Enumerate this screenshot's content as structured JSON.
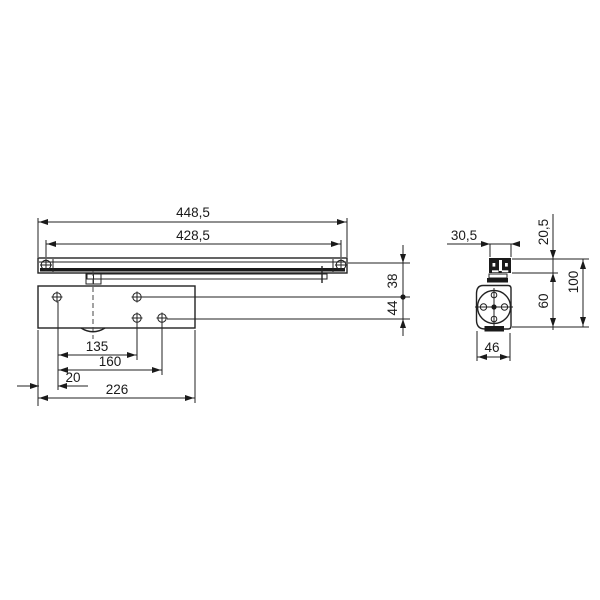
{
  "drawing": {
    "kind": "technical dimension drawing - overhead door closer with slide rail",
    "background_color": "#ffffff",
    "line_color": "#222222",
    "views": {
      "front": {
        "name": "front view",
        "dims": {
          "overall_length": "448,5",
          "fixing_centres": "428,5",
          "rail_axis_offset": "38",
          "spindle_axis_offset": "44",
          "hole_dim_135": "135",
          "hole_dim_160": "160",
          "edge_offset_20": "20",
          "body_length_226": "226"
        }
      },
      "side": {
        "name": "side view",
        "dims": {
          "rail_width": "30,5",
          "rail_height": "20,5",
          "total_height": "100",
          "body_height": "60",
          "body_width": "46"
        }
      }
    }
  }
}
